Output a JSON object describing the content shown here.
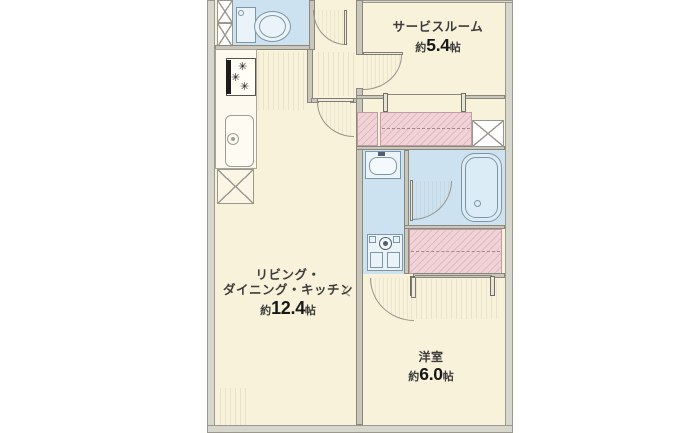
{
  "rooms": {
    "service_room": {
      "name": "サービスルーム",
      "area_prefix": "約",
      "area_value": "5.4",
      "area_unit": "帖"
    },
    "ldk": {
      "name_line1": "リビング・",
      "name_line2": "ダイニング・キッチン",
      "area_prefix": "約",
      "area_value": "12.4",
      "area_unit": "帖"
    },
    "western_room": {
      "name": "洋室",
      "area_prefix": "約",
      "area_value": "6.0",
      "area_unit": "帖"
    }
  },
  "colors": {
    "room_fill": "#f9f2da",
    "sanitary_fill": "#cde2f0",
    "closet_fill": "#f1d3d7",
    "wall_fill": "#c9c7bb",
    "outer_wall_fill": "#d7d6cc",
    "fixture_line": "#7f96a4",
    "label_text": "#3c3c3c"
  },
  "icons": [
    "toilet-icon",
    "gas-stove-icon",
    "kitchen-sink-icon",
    "washbasin-icon",
    "bathtub-icon",
    "washing-machine-icon",
    "pipe-space-x-icon",
    "duct-x-icon",
    "door-swing-arc",
    "closet-hanger-dash"
  ]
}
